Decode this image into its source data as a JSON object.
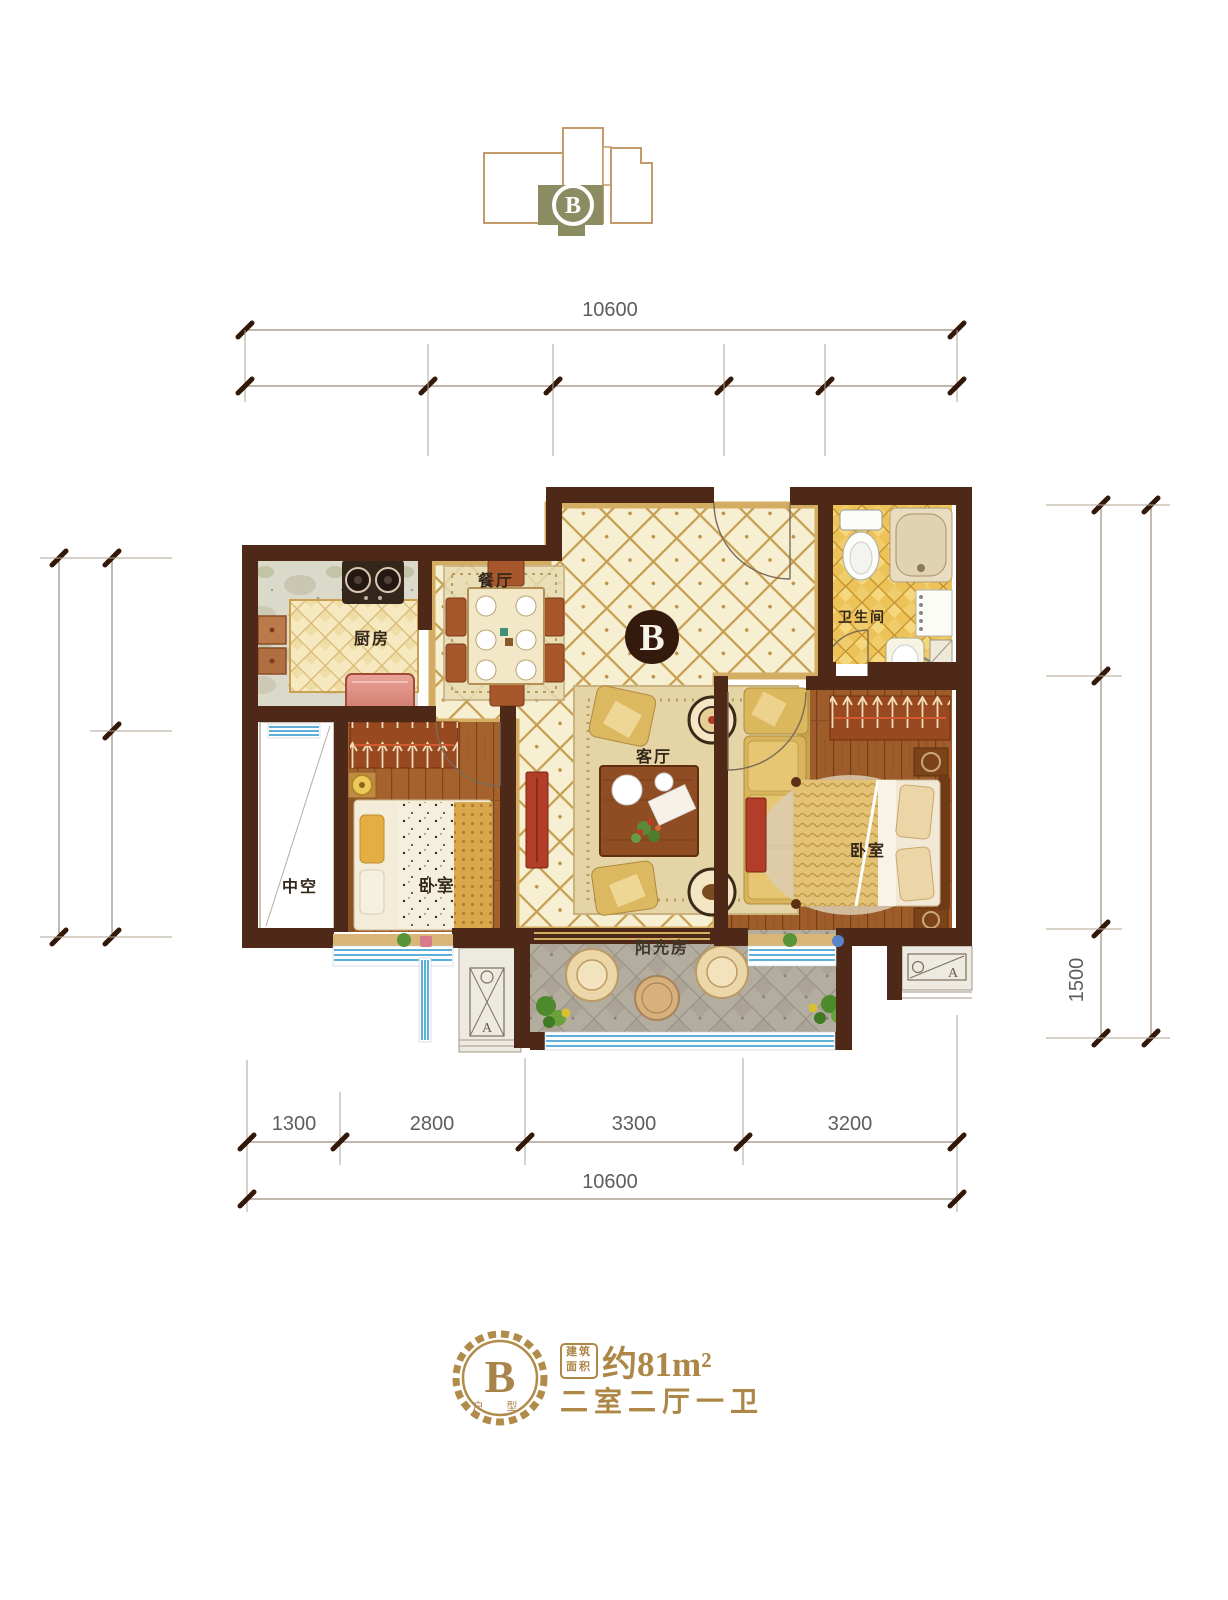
{
  "key_plan": {
    "unit": "B"
  },
  "dims": {
    "top_total": "10600",
    "bottom_segments": [
      "1300",
      "2800",
      "3300",
      "3200"
    ],
    "bottom_total": "10600",
    "right_segment": "1500"
  },
  "plan": {
    "unit_mark": "B",
    "ac_mark": "A",
    "rooms": {
      "kitchen": "厨房",
      "dining": "餐厅",
      "living": "客厅",
      "bedroom_left": "卧室",
      "bedroom_right": "卧室",
      "bathroom": "卫生间",
      "void": "中空",
      "sunroom": "阳光房"
    }
  },
  "summary": {
    "badge_letter": "B",
    "badge_caption": "户 型",
    "area_stamp": [
      "建筑",
      "面积"
    ],
    "area_value": "约81m²",
    "rooms_text": "二室二厅一卫"
  },
  "colors": {
    "gold": "#ac8747",
    "wall": "#4f2917",
    "olive": "#8c8c62",
    "window_blue": "#5fb0d8"
  }
}
